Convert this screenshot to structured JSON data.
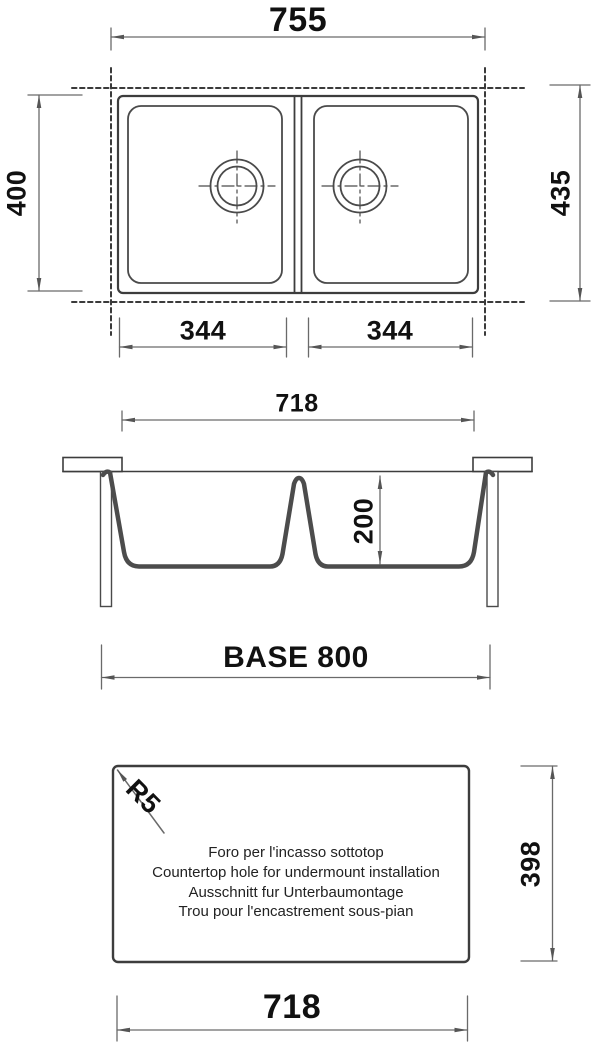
{
  "drawing_type": "sink installation technical drawing",
  "top_view": {
    "overall_width": "755",
    "bowl_depth_left": "400",
    "overall_depth_right": "435",
    "bowl_width_left": "344",
    "bowl_width_right": "344"
  },
  "section_view": {
    "rim_width": "718",
    "bowl_height": "200",
    "base_cabinet": "BASE 800"
  },
  "cutout_view": {
    "corner_radius": "R5",
    "cutout_height": "398",
    "cutout_width": "718",
    "notes": [
      "Foro per l'incasso sottotop",
      "Countertop hole for undermount installation",
      "Ausschnitt fur Unterbaumontage",
      "Trou pour l'encastrement sous-pian"
    ]
  },
  "colors": {
    "object_line": "#3d3d3d",
    "section_profile": "#4c4c4c",
    "dimension_line": "#6a6a6a",
    "text": "#111111",
    "background": "#ffffff"
  }
}
